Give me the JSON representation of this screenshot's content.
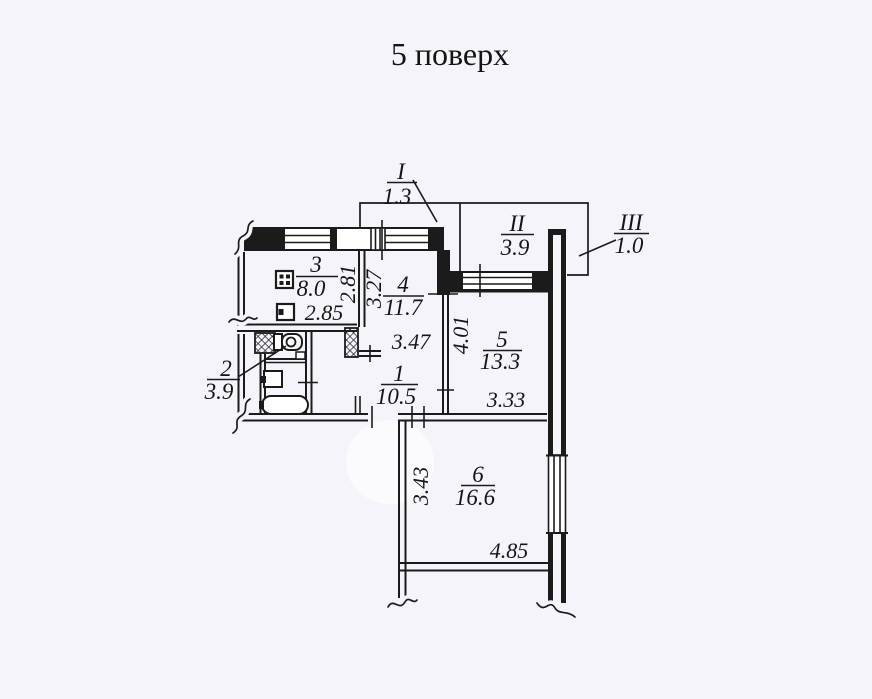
{
  "title": "5 поверх",
  "plan": {
    "ink_color": "#1b1b1b",
    "paper_color": "#f4f4fa",
    "balconies": [
      {
        "numeral": "I",
        "area": "1.3"
      },
      {
        "numeral": "II",
        "area": "3.9"
      },
      {
        "numeral": "III",
        "area": "1.0"
      }
    ],
    "rooms": [
      {
        "number": "1",
        "area": "10.5"
      },
      {
        "number": "2",
        "area": "3.9"
      },
      {
        "number": "3",
        "area": "8.0"
      },
      {
        "number": "4",
        "area": "11.7"
      },
      {
        "number": "5",
        "area": "13.3"
      },
      {
        "number": "6",
        "area": "16.6"
      }
    ],
    "dimensions": {
      "kitchen_depth": "2.81",
      "room4_depth": "3.27",
      "kitchen_width": "2.85",
      "room4_width": "3.47",
      "room5_depth": "4.01",
      "room5_width": "3.33",
      "room6_depth": "3.43",
      "room6_width": "4.85"
    },
    "fixtures": [
      "stove-icon",
      "kitchen-sink-icon",
      "ventilation-shaft-icon",
      "toilet-icon",
      "wash-basin-icon",
      "bathtub-icon"
    ]
  }
}
